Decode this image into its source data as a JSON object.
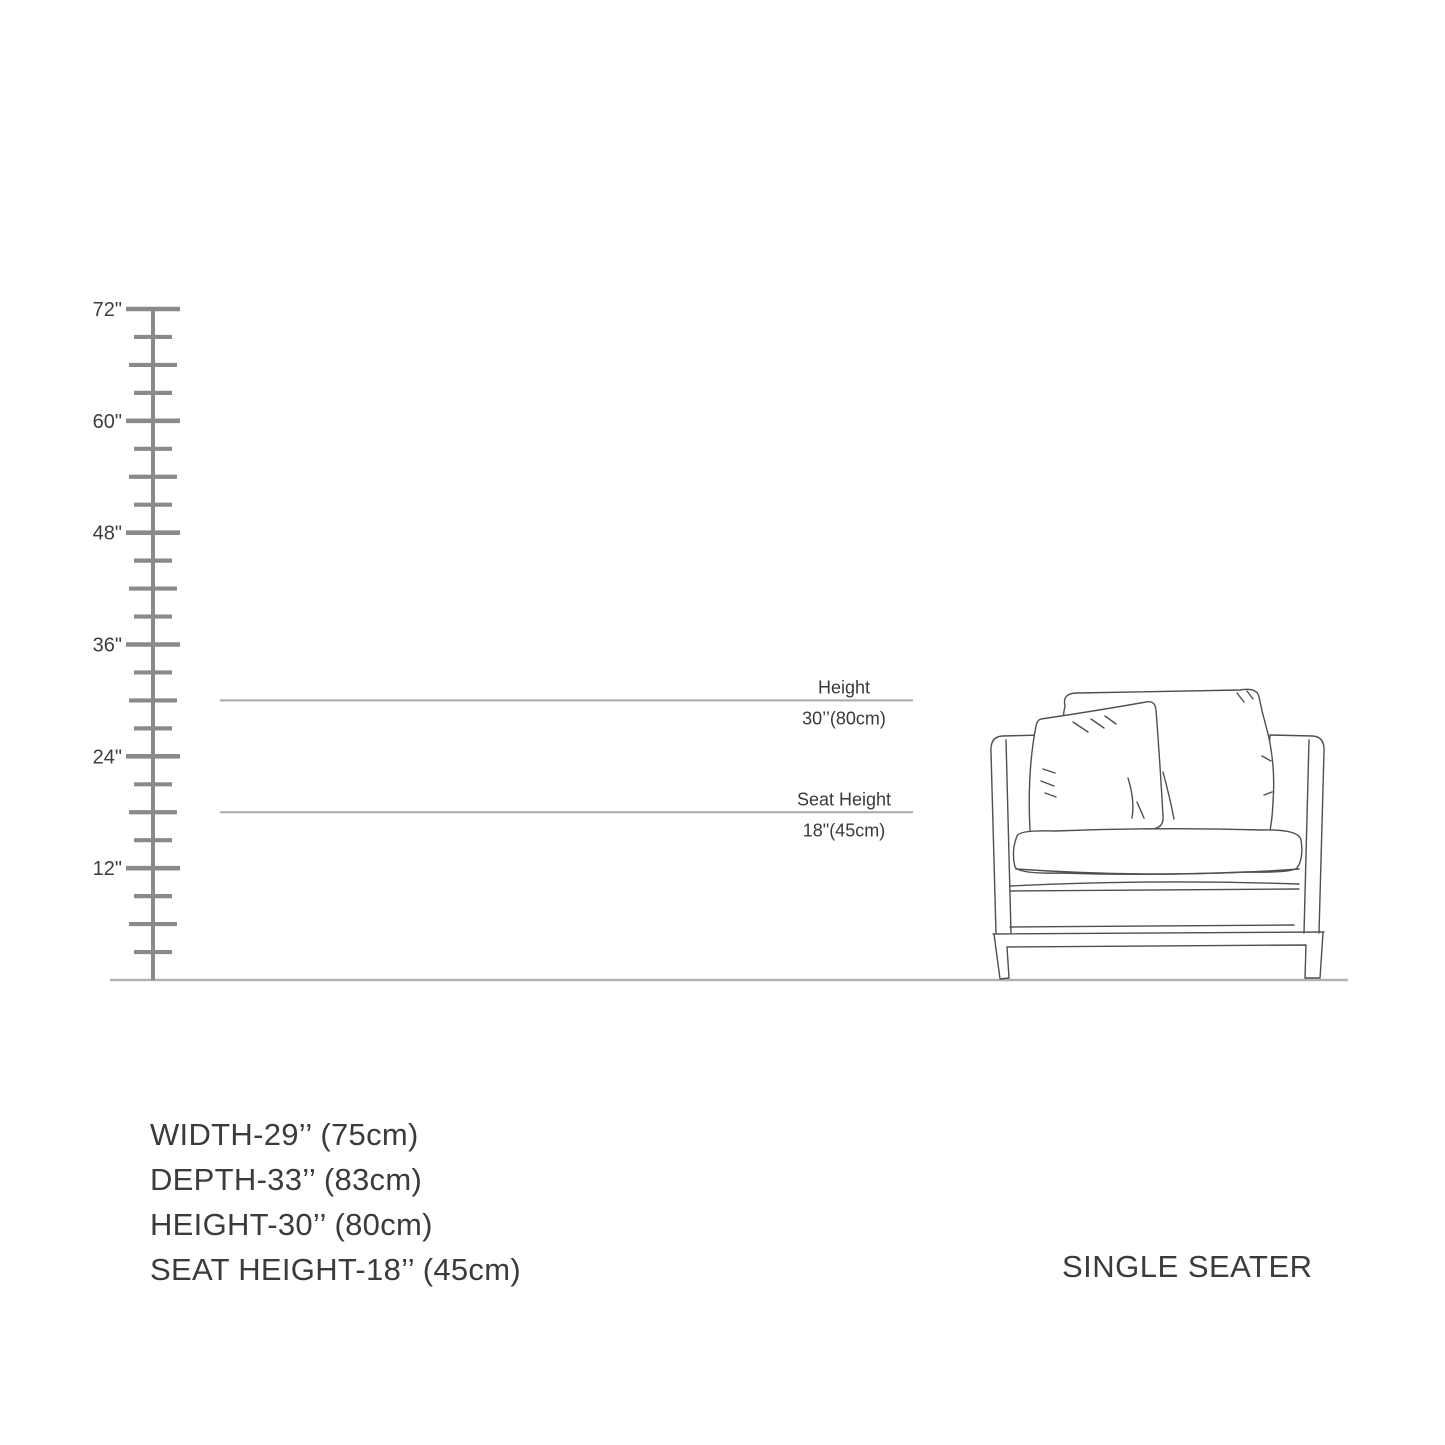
{
  "diagram": {
    "ruler": {
      "unit_suffix": "\"",
      "max_value": 72,
      "tick_step": 3,
      "major_every": 12,
      "medium_every": 6,
      "labels": [
        {
          "value": 72,
          "text": "72\""
        },
        {
          "value": 60,
          "text": "60\""
        },
        {
          "value": 48,
          "text": "48\""
        },
        {
          "value": 36,
          "text": "36\""
        },
        {
          "value": 24,
          "text": "24\""
        },
        {
          "value": 12,
          "text": "12\""
        }
      ]
    },
    "dimensions": [
      {
        "name": "height",
        "label": "Height",
        "value_text": "30’’(80cm)",
        "inches": 30
      },
      {
        "name": "seat-height",
        "label": "Seat Height",
        "value_text": "18\"(45cm)",
        "inches": 18
      }
    ]
  },
  "specs": {
    "lines": [
      "WIDTH-29’’ (75cm)",
      "DEPTH-33’’ (83cm)",
      "HEIGHT-30’’ (80cm)",
      "SEAT HEIGHT-18’’ (45cm)"
    ]
  },
  "product_label": "SINGLE SEATER",
  "colors": {
    "background": "#ffffff",
    "ruler": "#8a8a8a",
    "ground_line": "#b3b3b3",
    "dimension_line": "#a9a9a9",
    "text": "#3b3b3b",
    "sketch_ink": "#4f4f4f"
  }
}
